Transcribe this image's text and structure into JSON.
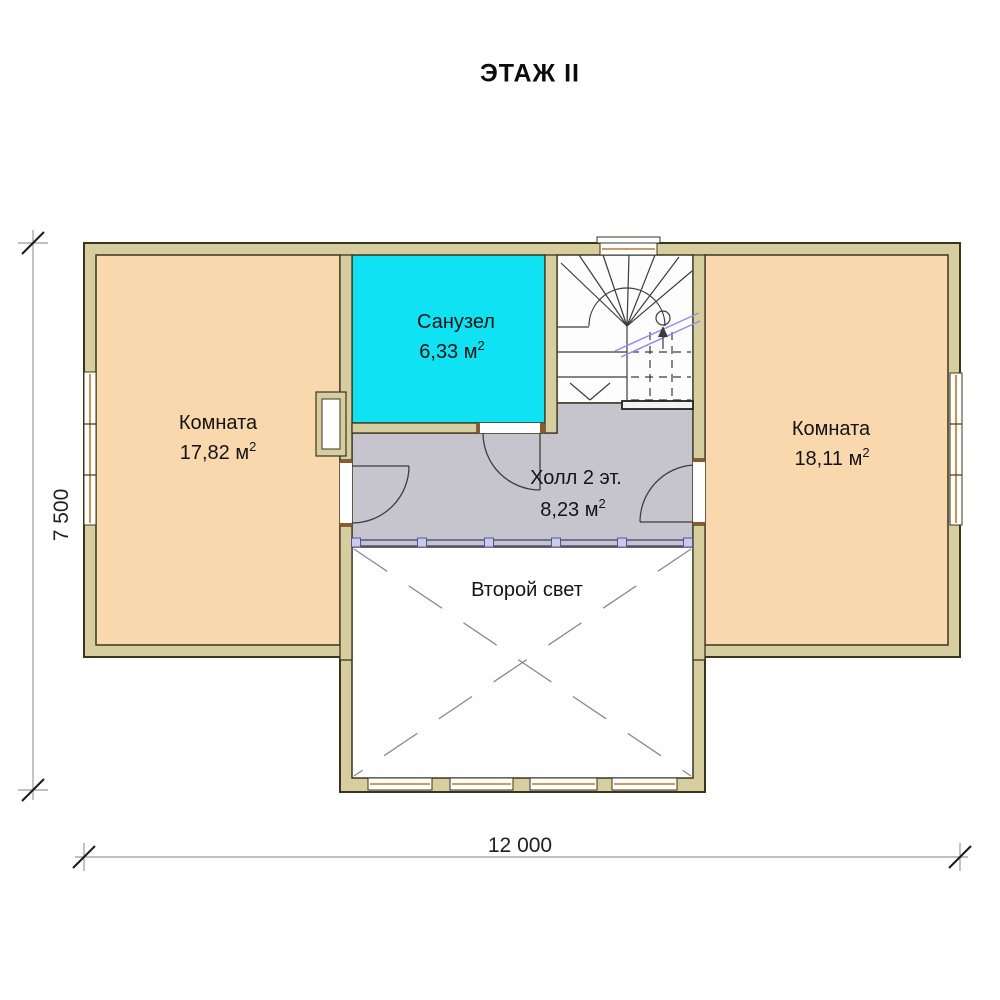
{
  "title": "ЭТАЖ II",
  "rooms": [
    {
      "id": "room-left",
      "name": "Комната",
      "area": "17,82",
      "unit": "м",
      "sup": "2"
    },
    {
      "id": "bathroom",
      "name": "Санузел",
      "area": "6,33",
      "unit": "м",
      "sup": "2"
    },
    {
      "id": "hall",
      "name": "Холл 2 эт.",
      "area": "8,23",
      "unit": "м",
      "sup": "2"
    },
    {
      "id": "room-right",
      "name": "Комната",
      "area": "18,11",
      "unit": "м",
      "sup": "2"
    },
    {
      "id": "void",
      "name": "Второй свет"
    }
  ],
  "dimensions": {
    "overall_width": "12 000",
    "overall_depth": "7 500"
  },
  "colors": {
    "wall_fill": "#d6ce9e",
    "wall_outline": "#3b3520",
    "room_fill": "#f9d8ae",
    "wet_room_fill": "#0fe3f3",
    "hall_fill": "#c6c5cd",
    "void_fill": "#fefefe",
    "railing": "#55558c",
    "window_frame": "#c2762e"
  }
}
